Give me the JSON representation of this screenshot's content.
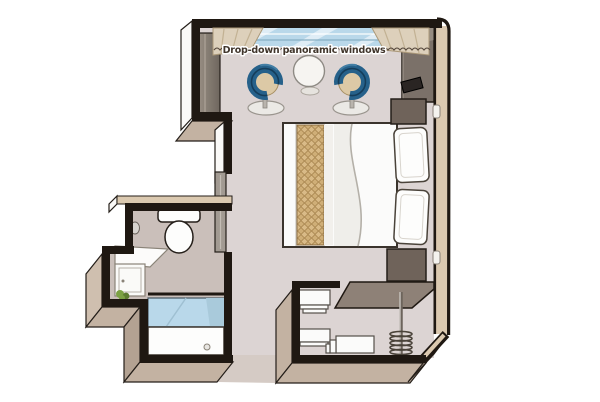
{
  "plan": {
    "title": "cabin-floor-plan",
    "window_label": "Drop-down panoramic windows",
    "rooms": [
      "bedroom",
      "bathroom",
      "entry-corridor",
      "closet"
    ],
    "furniture": [
      "drop-down panoramic windows",
      "curtains",
      "tub armchair",
      "tub armchair",
      "round side table",
      "wardrobe",
      "tv-corner-unit",
      "tv",
      "nightstand",
      "double bed",
      "bed runner",
      "pillows",
      "nightstand",
      "sliding door",
      "toilet",
      "mirror",
      "washbasin vanity",
      "plant",
      "shower",
      "shelf unit",
      "luggage bench",
      "open wardrobe with hanging rail"
    ]
  },
  "colors": {
    "wallBlack": "#1f1812",
    "outline": "#241e19",
    "wallCapBeige": "#dbc9b0",
    "faceTan": "#c3b2a2",
    "faceTanLight": "#cfbfaf",
    "faceTanDark": "#b3a292",
    "faceWhite": "#faf9f7",
    "floorMain": "#dcd4d3",
    "floorBath": "#cabfba",
    "floorEntry": "#d5cbc5",
    "glassBlue": "#b9d8ea",
    "glassLine": "#86aec4",
    "curtainBeige": "#ddd0bb",
    "curtainEdge": "#ab9878",
    "chairBlue": "#26618a",
    "chairBlueDark": "#153d5a",
    "chairBlueLight": "#447fa5",
    "cushionBeige": "#dcc9a6",
    "cushionEdge": "#a78f63",
    "runnerTan": "#d2b183",
    "runnerTanDark": "#a8854f",
    "furnitureDark": "#6f635a",
    "tvBlack": "#2a2523",
    "wardrobeGray": "#847a70",
    "doorGray": "#a29a92",
    "canopyTaupe": "#8e8177",
    "white": "#fdfdfc",
    "shelfWhite": "#fbfbfa",
    "plantGreen": "#7ca144",
    "plantGreenDark": "#5d7c31",
    "textColor": "#41362c"
  }
}
